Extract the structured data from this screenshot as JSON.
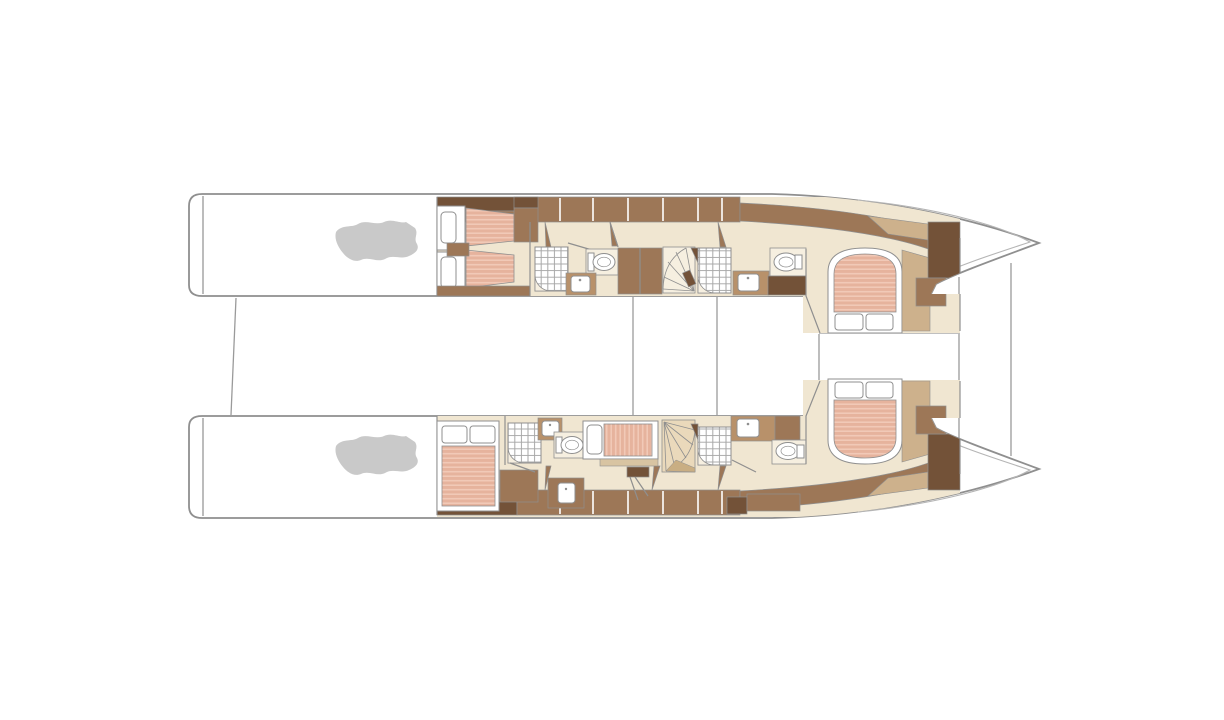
{
  "figure": {
    "type": "yacht-deck-plan",
    "view": "overhead lower-deck layout of a twin-hull catamaran, bows pointing right",
    "background": "#ffffff",
    "description": "Deck plan of a catamaran lower deck: two parallel hulls each with engine room aft, guest cabin, bathrooms with shower and toilet, spiral staircase and a forward double cabin; trampoline crossbeams drawn between the bows."
  },
  "palette": {
    "outline": "#8f8f8f",
    "outline_soft": "#b5b5b5",
    "deck_line": "#9a9a9a",
    "hull_white": "#ffffff",
    "floor": "#f0e6d1",
    "floor_light": "#f6efe0",
    "brown_mid": "#9d7757",
    "brown_dark": "#735238",
    "brown_light": "#b8916a",
    "tan": "#cdb18c",
    "shelf_tan": "#d8c4a2",
    "mattress": "#e6b39d",
    "mattress_stripe": "#f1c9b7",
    "engine_gray": "#c9c9c9",
    "stair_light": "#ead9bb",
    "stair_dark": "#c9ae83",
    "fixture_white": "#ffffff"
  },
  "hulls": {
    "port": {
      "side": "top",
      "rooms": [
        "engine-room",
        "twin-guest-cabin",
        "bathroom-with-shower",
        "wardrobe",
        "spiral-staircase",
        "shower-room",
        "bathroom",
        "forward-double-cabin"
      ]
    },
    "starboard": {
      "side": "bottom",
      "rooms": [
        "engine-room",
        "double-guest-cabin",
        "bathroom-with-shower",
        "single-berth-cabin-with-desk",
        "spiral-staircase",
        "shower-room",
        "bathroom",
        "forward-double-cabin"
      ]
    }
  },
  "fixtures": {
    "engines": 2,
    "staircases": 2,
    "showers": 4,
    "toilets": 4,
    "sinks": 5,
    "double_beds": 3,
    "single_beds": 3
  }
}
